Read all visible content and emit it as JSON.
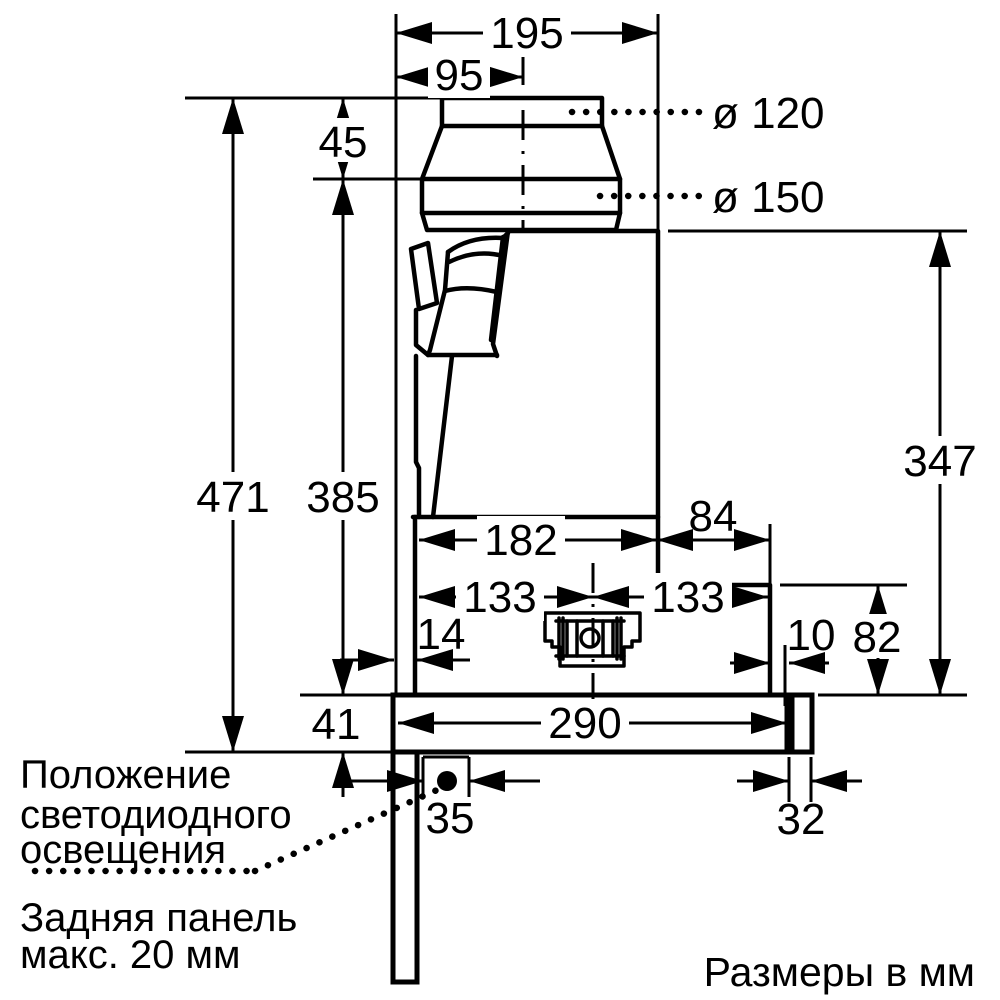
{
  "diagram": {
    "dimensions": {
      "total_width": "195",
      "duct_center_offset": "95",
      "collar_height": "45",
      "duct_diameter_small": "ø 120",
      "duct_diameter_large": "ø 150",
      "overall_height": "471",
      "height_to_flange": "385",
      "body_height": "347",
      "body_depth": "182",
      "rear_step_depth": "84",
      "center_to_back": "133",
      "center_to_front": "133",
      "back_clearance": "14",
      "step_clearance": "10",
      "lower_section_height": "82",
      "canopy_height": "41",
      "canopy_depth": "290",
      "led_offset": "35",
      "rear_edge_width": "32"
    },
    "notes": {
      "led_note": [
        "Положение",
        "светодиодного",
        "освещения"
      ],
      "back_panel_note": [
        "Задняя панель",
        "макс. 20 мм"
      ],
      "units_note": "Размеры в мм"
    },
    "colors": {
      "line": "#000000",
      "background": "#ffffff"
    }
  }
}
